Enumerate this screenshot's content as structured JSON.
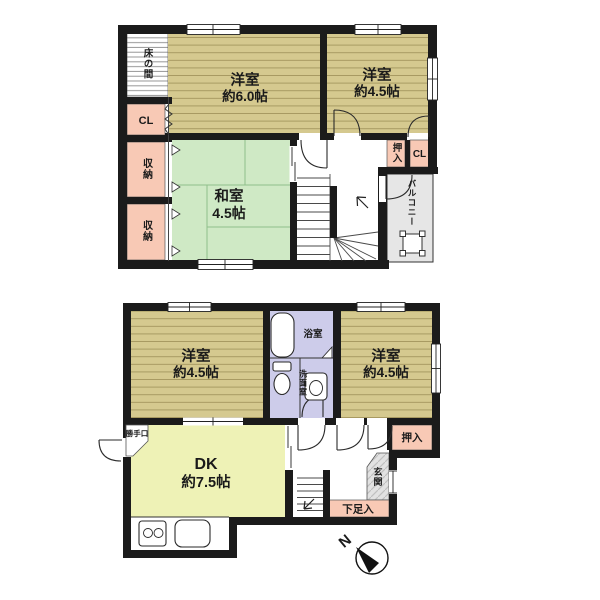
{
  "colors": {
    "wall": "#1b1b1b",
    "outline": "#2e2e2e",
    "wood_floor": "#d5c98f",
    "wood_floor_line": "#a3965e",
    "tatami": "#cfe9c5",
    "tatami_line": "#8fbf8a",
    "closet_pink": "#f8c9b5",
    "bath_lavender": "#cdccea",
    "dk_yellow": "#eef2b6",
    "balcony_gray": "#e6e6e6",
    "genkan_gray": "#e2e2e2",
    "tokonoma_line": "#8b8b8b"
  },
  "floor2": {
    "tokonoma": "床の間",
    "cl_left": "CL",
    "storage_top": "収納",
    "storage_bottom": "収納",
    "yoshitsu6_name": "洋室",
    "yoshitsu6_size": "約6.0帖",
    "yoshitsu45_name": "洋室",
    "yoshitsu45_size": "約4.5帖",
    "washitsu_name": "和室",
    "washitsu_size": "4.5帖",
    "oshiire": "押入",
    "cl_right": "CL",
    "balcony": "バルコニー"
  },
  "floor1": {
    "yoshitsu_left_name": "洋室",
    "yoshitsu_left_size": "約4.5帖",
    "bathroom": "浴室",
    "washroom": "洗面室",
    "yoshitsu_right_name": "洋室",
    "yoshitsu_right_size": "約4.5帖",
    "dk_name": "DK",
    "dk_size": "約7.5帖",
    "katteguchi": "勝手口",
    "oshiire": "押入",
    "genkan": "玄関",
    "getabako": "下足入"
  },
  "compass": {
    "north": "N"
  }
}
